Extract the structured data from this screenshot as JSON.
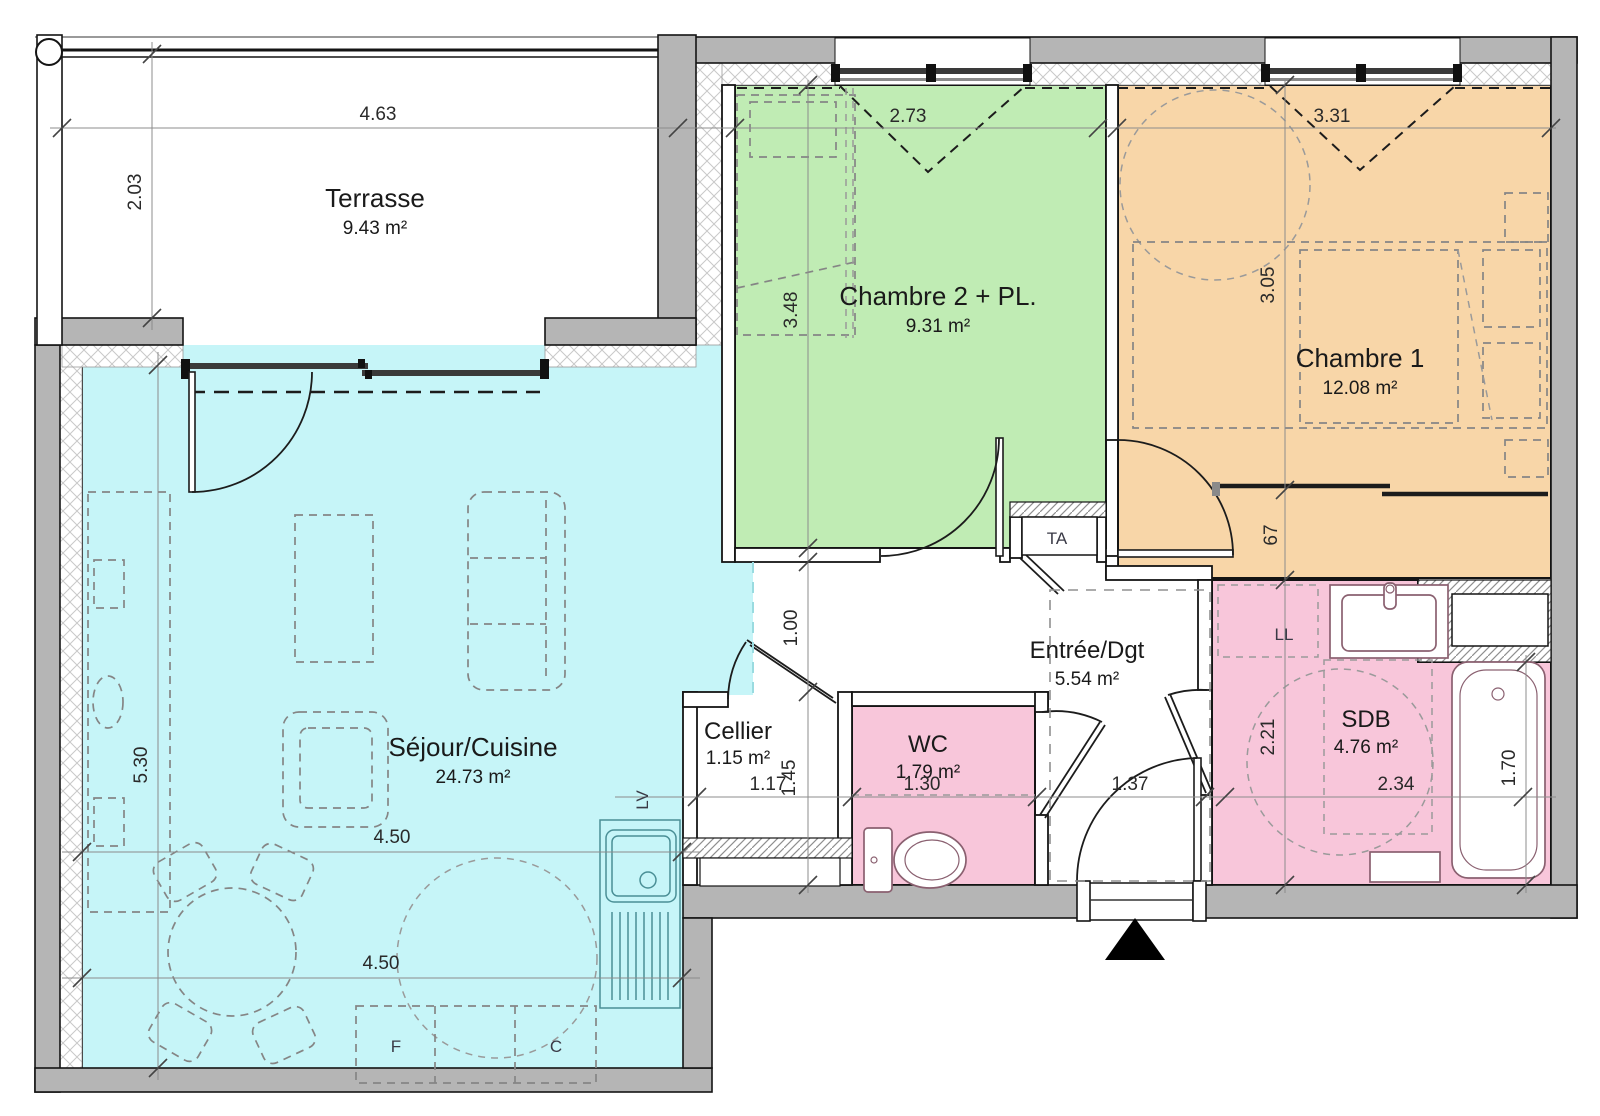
{
  "plan": {
    "colors": {
      "wall": "#b5b5b5",
      "terrasse": "#ffffff",
      "sejour": "#c6f5f8",
      "chambre2": "#c0ecb4",
      "chambre1": "#f8d6a8",
      "wet": "#f8c6da"
    },
    "rooms": [
      {
        "id": "terrasse",
        "name": "Terrasse",
        "area": "9.43 m²"
      },
      {
        "id": "sejour",
        "name": "Séjour/Cuisine",
        "area": "24.73 m²"
      },
      {
        "id": "chambre2",
        "name": "Chambre 2 + PL.",
        "area": "9.31 m²"
      },
      {
        "id": "chambre1",
        "name": "Chambre 1",
        "area": "12.08 m²"
      },
      {
        "id": "entree",
        "name": "Entrée/Dgt",
        "area": "5.54 m²"
      },
      {
        "id": "cellier",
        "name": "Cellier",
        "area": "1.15 m²"
      },
      {
        "id": "wc",
        "name": "WC",
        "area": "1.79 m²"
      },
      {
        "id": "sdb",
        "name": "SDB",
        "area": "4.76 m²"
      }
    ],
    "dims": {
      "terrace_width": "4.63",
      "terrace_depth": "2.03",
      "chambre2_width": "2.73",
      "chambre1_width": "3.31",
      "chambre2_height": "3.48",
      "chambre1_height": "3.05",
      "sejour_height": "5.30",
      "sejour_width_mid": "4.50",
      "sejour_width_low": "4.50",
      "hall_width": "1.00",
      "cellier_width": "1.17",
      "cellier_depth": "1.45",
      "wc_width": "1.30",
      "entry_width": "1.37",
      "sdb_width": "2.34",
      "sdb_height": "2.21",
      "wardrobe_depth": "67",
      "bath_length": "1.70"
    },
    "labels": {
      "ta": "TA",
      "ll": "LL",
      "lv": "LV",
      "fridge": "F",
      "cooker": "C"
    }
  }
}
